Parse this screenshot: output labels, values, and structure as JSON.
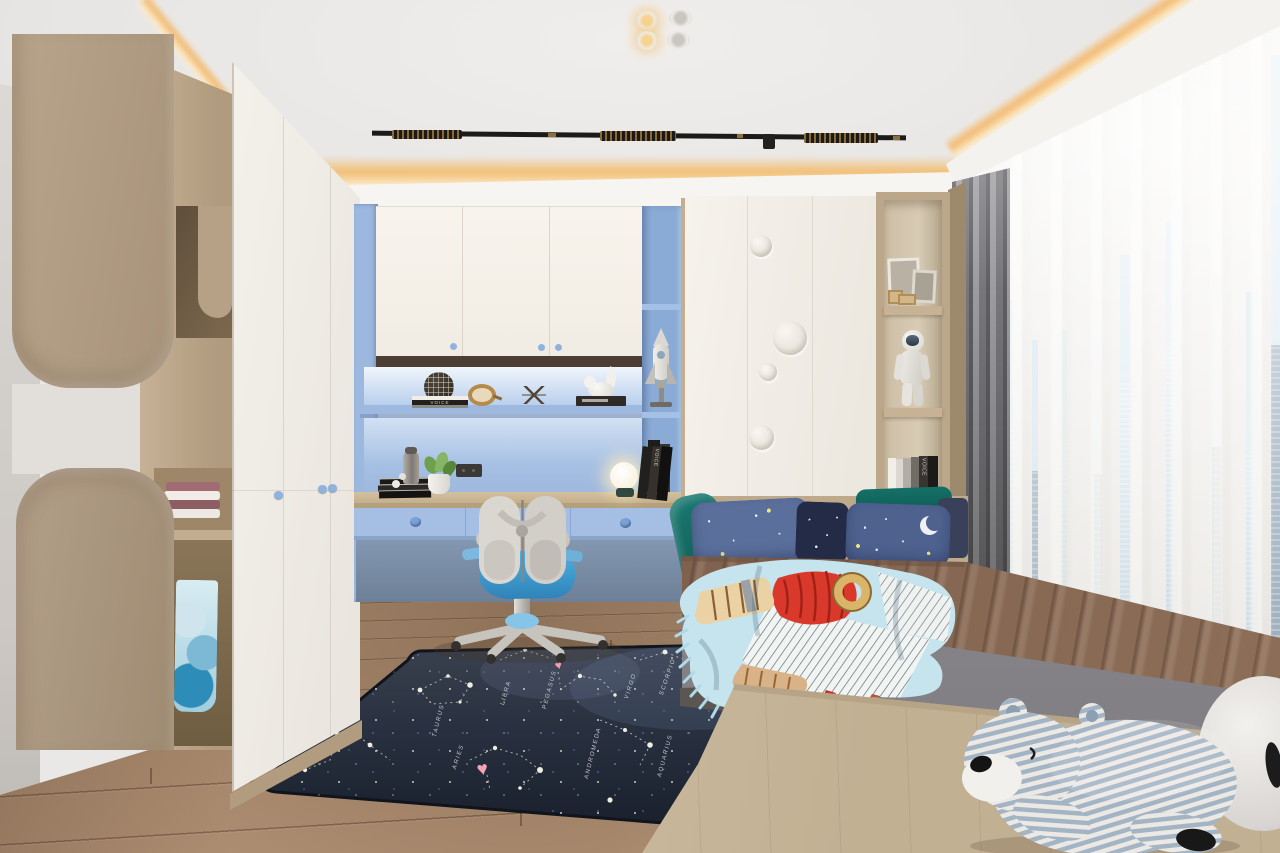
{
  "meta": {
    "title": "Children's bedroom — 3D interior render",
    "view": "wide corner view"
  },
  "palette": {
    "cove_glow": "#f2b96e",
    "accent_blue": "#a2bde4",
    "chair_seat_blue": "#3f9fd4",
    "wood": "#b6a289",
    "rug_navy": "#222a3a",
    "quilt_brown": "#8d6f59",
    "pillow_teal": "#15655f",
    "floor_oak": "#a9886a",
    "white_cabinet": "#f4f1ea"
  },
  "ceiling": {
    "label": "tray ceiling with warm LED cove",
    "spotlights_lit": 2,
    "spotlights_off": 2,
    "track_light": "black linear track light"
  },
  "left_wall": {
    "switch": "brass switch plate"
  },
  "left_cabinet": {
    "label": "curved oak cabinet panels",
    "towels": "folded towels",
    "clothes": "hanging kids jacket"
  },
  "left_wardrobe": {
    "label": "white three-door wardrobe",
    "knobs": "blue cloud knobs"
  },
  "study_nook": {
    "label": "built-in study nook",
    "back_panel": "powder blue",
    "cabinets": "white overhead cabinets",
    "book_spine": "VOICE",
    "shelf_items": [
      "wire sphere",
      "book stack",
      "brass clock",
      "dragonfly ornament",
      "bird sculpture"
    ],
    "desk_items": [
      "thermos",
      "white orbs",
      "potted plant",
      "socket",
      "globe lamp",
      "leaning books"
    ],
    "rocket": "white rocket model"
  },
  "chair": {
    "label": "kids ergonomic desk chair",
    "frame": "light grey",
    "seat": "sky blue"
  },
  "right_wardrobe": {
    "label": "white wardrobe with bubble reliefs",
    "circles": 4
  },
  "right_shelf": {
    "label": "oak display shelf",
    "items": [
      "photo frames",
      "astronaut figurine",
      "book row"
    ],
    "book_spine": "VOICE"
  },
  "bed": {
    "label": "platform bed",
    "pillows": [
      "teal satin",
      "starry blue",
      "navy galaxy"
    ],
    "quilt": "brown satin quilt",
    "mattress": "grey fabric mattress",
    "throw": "rocket-print fringe blanket"
  },
  "rug": {
    "label": "constellation map rug",
    "constellations": [
      "ERIDANUS",
      "TAURUS",
      "ARIES",
      "LIBRA",
      "PEGASUS",
      "VIRGO",
      "SCORPIO",
      "ANDROMEDA",
      "AQUARIUS"
    ],
    "hearts": 2
  },
  "window": {
    "label": "floor-to-ceiling window",
    "sheers": "white sheer curtains",
    "drape": "grey blackout curtain",
    "view": "city skyline"
  },
  "toys": {
    "bear": "striped plush bear",
    "white_plush": "round white plush"
  },
  "floor": {
    "label": "oak plank floor"
  },
  "platform": {
    "label": "light oak bed platform"
  }
}
